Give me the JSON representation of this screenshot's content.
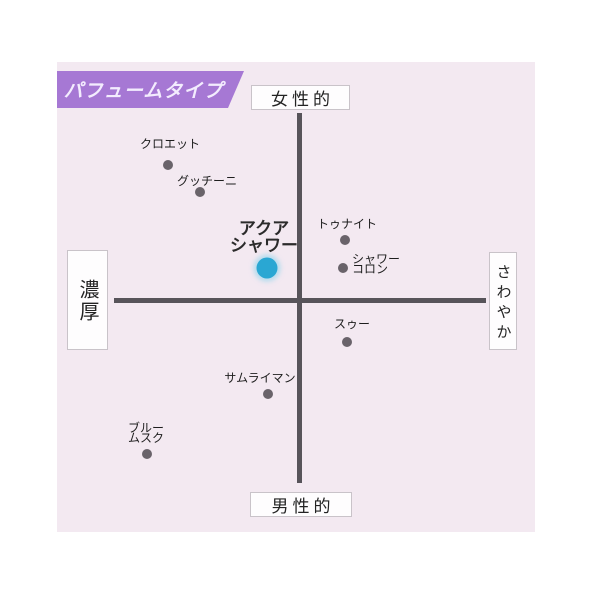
{
  "badge": {
    "label": "パフュームタイプ"
  },
  "chart_data": {
    "type": "scatter",
    "title": "パフュームタイプ",
    "x_axis": {
      "left_label": "濃厚",
      "right_label": "さわやか"
    },
    "y_axis": {
      "top_label": "女性的",
      "bottom_label": "男性的"
    },
    "axis_range": {
      "x": [
        -1,
        1
      ],
      "y": [
        -1,
        1
      ]
    },
    "grid": false,
    "points": [
      {
        "name": "クロエット",
        "lines": [
          "クロエット"
        ],
        "highlight": false,
        "px": {
          "x": 168,
          "y": 165
        },
        "label": {
          "x": 170,
          "y": 144,
          "anchor": "center"
        },
        "value": {
          "x": -0.69,
          "y": 0.74
        }
      },
      {
        "name": "グッチーニ",
        "lines": [
          "グッチーニ"
        ],
        "highlight": false,
        "px": {
          "x": 200,
          "y": 192
        },
        "label": {
          "x": 207,
          "y": 181,
          "anchor": "center"
        },
        "value": {
          "x": -0.53,
          "y": 0.59
        }
      },
      {
        "name": "アクアシャワー",
        "lines": [
          "アクア",
          "シャワー"
        ],
        "highlight": true,
        "px": {
          "x": 267,
          "y": 268
        },
        "label": {
          "x": 264,
          "y": 237,
          "anchor": "center"
        },
        "value": {
          "x": -0.17,
          "y": 0.17
        }
      },
      {
        "name": "トゥナイト",
        "lines": [
          "トゥナイト"
        ],
        "highlight": false,
        "px": {
          "x": 345,
          "y": 240
        },
        "label": {
          "x": 347,
          "y": 224,
          "anchor": "center"
        },
        "value": {
          "x": 0.24,
          "y": 0.33
        }
      },
      {
        "name": "シャワーコロン",
        "lines": [
          "シャワー",
          "コロン"
        ],
        "highlight": false,
        "px": {
          "x": 343,
          "y": 268
        },
        "label": {
          "x": 352,
          "y": 264,
          "anchor": "left"
        },
        "value": {
          "x": 0.23,
          "y": 0.17
        }
      },
      {
        "name": "スゥー",
        "lines": [
          "スゥー"
        ],
        "highlight": false,
        "px": {
          "x": 347,
          "y": 342
        },
        "label": {
          "x": 352,
          "y": 324,
          "anchor": "center"
        },
        "value": {
          "x": 0.25,
          "y": -0.23
        }
      },
      {
        "name": "サムライマン",
        "lines": [
          "サムライマン"
        ],
        "highlight": false,
        "px": {
          "x": 268,
          "y": 394
        },
        "label": {
          "x": 260,
          "y": 378,
          "anchor": "center"
        },
        "value": {
          "x": -0.17,
          "y": -0.51
        }
      },
      {
        "name": "ブルームスク",
        "lines": [
          "ブルー",
          "ムスク"
        ],
        "highlight": false,
        "px": {
          "x": 147,
          "y": 454
        },
        "label": {
          "x": 146,
          "y": 433,
          "anchor": "center"
        },
        "value": {
          "x": -0.81,
          "y": -0.84
        }
      }
    ]
  },
  "colors": {
    "panel_bg": "#f3e9f1",
    "badge_bg": "#a678d4",
    "badge_text": "#f3ecfe",
    "axis_line": "#57545a",
    "dot": "#69636a",
    "highlight_dot": "#2aa7d3",
    "label_text": "#1e1e1e",
    "box_border": "#c9c3c9",
    "box_bg": "#fefdfe"
  }
}
